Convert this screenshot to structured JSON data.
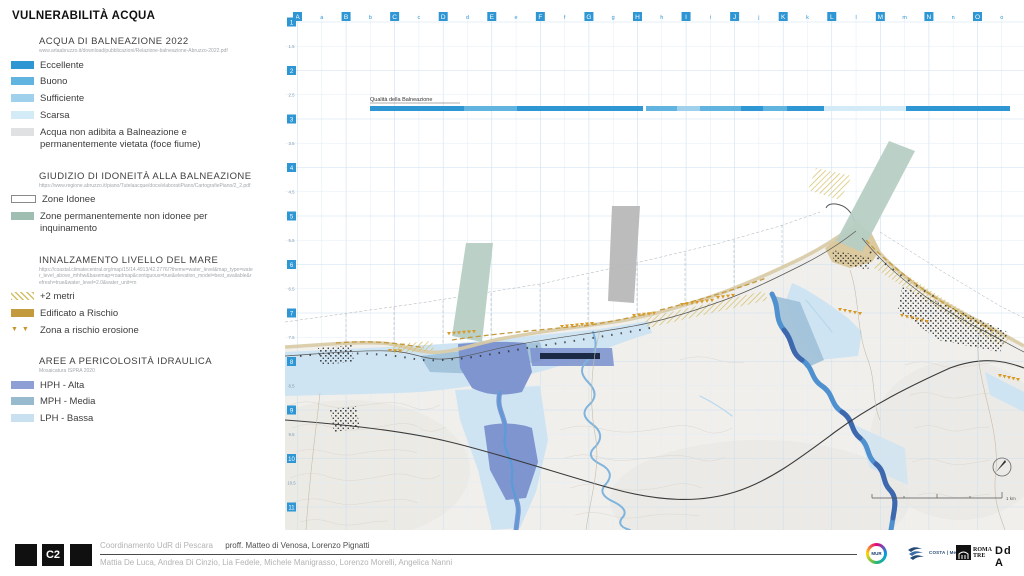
{
  "title": "VULNERABILITÀ ACQUA",
  "colors": {
    "grid_badge": "#2f96d4",
    "quality": {
      "eccellente": "#2f96d4",
      "buono": "#62b4e0",
      "sufficiente": "#9fd0ec",
      "scarsa": "#d3eaf7"
    }
  },
  "legend": {
    "sections": [
      {
        "heading": "ACQUA DI BALNEAZIONE 2022",
        "source": "www.artaabruzzo.it/download/pubblicazioni/Relazione-balneazione-Abruzzo-2022.pdf",
        "items": [
          {
            "label": "Eccellente",
            "color": "#2f96d4",
            "swatch": "fill"
          },
          {
            "label": "Buono",
            "color": "#62b4e0",
            "swatch": "fill"
          },
          {
            "label": "Sufficiente",
            "color": "#9fd0ec",
            "swatch": "fill"
          },
          {
            "label": "Scarsa",
            "color": "#d3eaf7",
            "swatch": "fill"
          },
          {
            "label": "Acqua non adibita a Balneazione e permanentemente vietata (foce fiume)",
            "color": "#dfe1e3",
            "swatch": "fill"
          }
        ]
      },
      {
        "heading": "GIUDIZIO DI IDONEITÀ ALLA BALNEAZIONE",
        "source": "https://www.regione.abruzzo.it/piano/Tutelaacque/docs/elaboratiPiano/CartografiePiano/2_2.pdf",
        "items": [
          {
            "label": "Zone Idonee",
            "color": "#ffffff",
            "swatch": "outline"
          },
          {
            "label": "Zone permanentemente non idonee per inquinamento",
            "color": "#9fbdb1",
            "swatch": "fill"
          }
        ]
      },
      {
        "heading": "INNALZAMENTO LIVELLO DEL MARE",
        "source": "https://coastal.climatecentral.org/map/15/14.4913/42.2776/?theme=water_level&map_type=water_level_above_mhhw&basemap=roadmap&contiguous=true&elevation_model=best_available&refresh=true&water_level=2.0&water_unit=m",
        "items": [
          {
            "label": "+2 metri",
            "color": "#d4bf66",
            "swatch": "hatch"
          },
          {
            "label": "Edificato a Rischio",
            "color": "#c49a3f",
            "swatch": "fill"
          },
          {
            "label": "Zona a rischio erosione",
            "color": "#cd9428",
            "swatch": "triangles"
          }
        ]
      },
      {
        "heading": "AREE A PERICOLOSITÀ IDRAULICA",
        "source": "Mosaicatura ISPRA 2020",
        "items": [
          {
            "label": "HPH - Alta",
            "color": "#8e9fd6",
            "swatch": "fill"
          },
          {
            "label": "MPH - Media",
            "color": "#98bacf",
            "swatch": "fill"
          },
          {
            "label": "LPH - Bassa",
            "color": "#c9e0f0",
            "swatch": "fill"
          }
        ]
      }
    ]
  },
  "map": {
    "grid": {
      "columns": [
        "A",
        "B",
        "C",
        "D",
        "E",
        "F",
        "G",
        "H",
        "I",
        "J",
        "K",
        "L",
        "M",
        "N",
        "O"
      ],
      "sub_columns": [
        "a",
        "b",
        "c",
        "d",
        "e",
        "f",
        "g",
        "h",
        "i",
        "j",
        "k",
        "l",
        "m",
        "n",
        "o"
      ],
      "rows": [
        "1",
        "2",
        "3",
        "4",
        "5",
        "6",
        "7",
        "8",
        "9",
        "10",
        "11"
      ],
      "sub_rows": [
        "1.5",
        "2.5",
        "3.5",
        "4.5",
        "5.5",
        "6.5",
        "7.5",
        "8.5",
        "9.5",
        "10.5"
      ]
    },
    "bathing_bar": {
      "label": "Qualità della Balneazione",
      "segments": [
        {
          "x1": 370,
          "x2": 464,
          "quality": "eccellente"
        },
        {
          "x1": 464,
          "x2": 517,
          "quality": "buono"
        },
        {
          "x1": 517,
          "x2": 643,
          "quality": "eccellente"
        },
        {
          "x1": 646,
          "x2": 677,
          "quality": "buono"
        },
        {
          "x1": 677,
          "x2": 700,
          "quality": "sufficiente"
        },
        {
          "x1": 700,
          "x2": 741,
          "quality": "buono"
        },
        {
          "x1": 741,
          "x2": 763,
          "quality": "eccellente"
        },
        {
          "x1": 763,
          "x2": 787,
          "quality": "buono"
        },
        {
          "x1": 787,
          "x2": 824,
          "quality": "eccellente"
        },
        {
          "x1": 824,
          "x2": 906,
          "quality": "scarsa"
        },
        {
          "x1": 906,
          "x2": 1010,
          "quality": "eccellente"
        }
      ]
    },
    "scale_label": "1 km"
  },
  "footer": {
    "sheet_code": "C2",
    "coordination": "Coordinamento UdR di Pescara",
    "professors": "proff. Matteo di Venosa, Lorenzo Pignatti",
    "authors": "Mattia De Luca, Andrea Di Cinzio, Lia Fedele, Michele Manigrasso, Lorenzo Morelli, Angelica Nanni",
    "logos": {
      "mur": "MUR",
      "costa": "COSTA | Med",
      "romatre_top": "ROMA",
      "romatre_bottom": "TRE",
      "dda": "Dd A"
    }
  }
}
